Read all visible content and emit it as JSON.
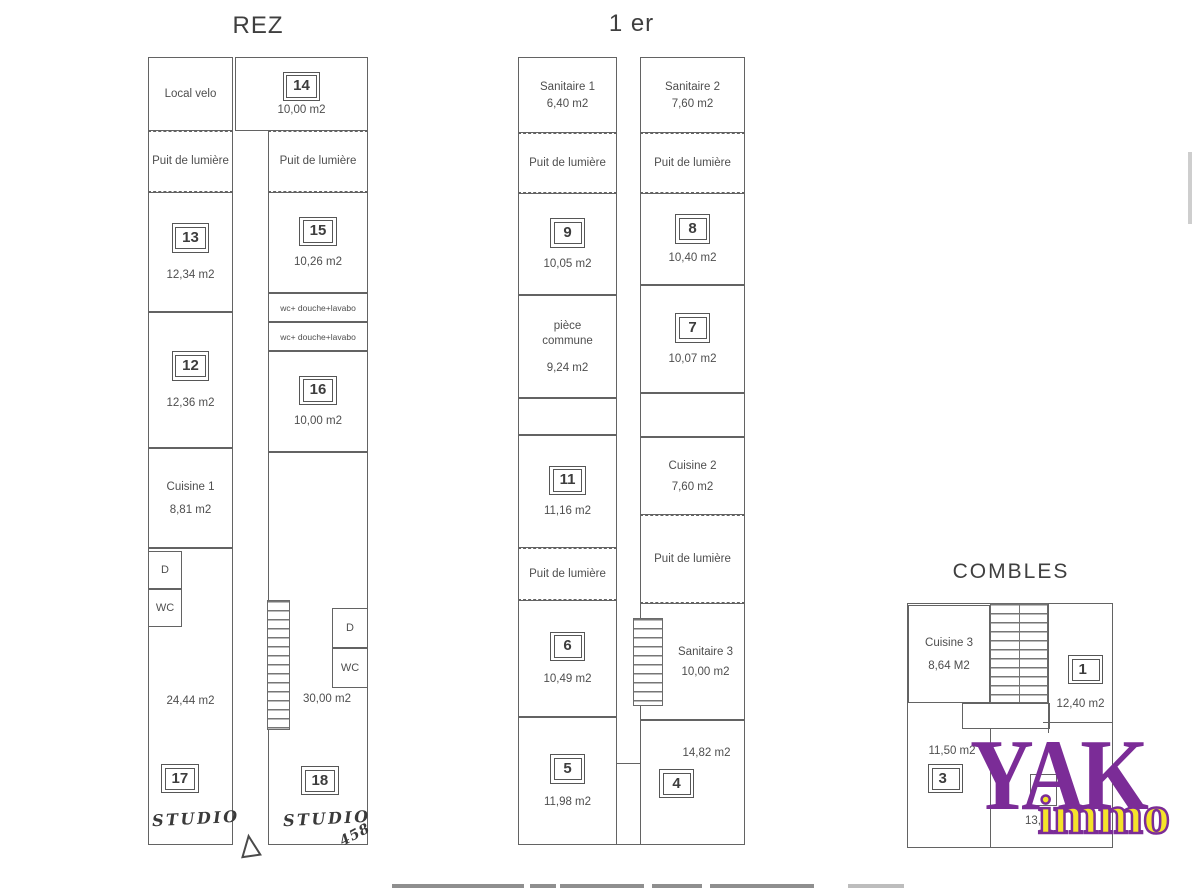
{
  "titles": {
    "rez": "REZ",
    "premier": "1 er",
    "combles": "COMBLES"
  },
  "rez": {
    "local_velo": "Local velo",
    "puit_left": "Puit de lumière",
    "puit_right": "Puit de lumière",
    "r13": {
      "num": "13",
      "area": "12,34 m2"
    },
    "r12": {
      "num": "12",
      "area": "12,36 m2"
    },
    "cuisine": {
      "name": "Cuisine 1",
      "area": "8,81 m2"
    },
    "d_left": "D",
    "wc_left": "WC",
    "r17": {
      "num": "17",
      "area": "24,44 m2",
      "note": "Studio"
    },
    "r14": {
      "num": "14",
      "area": "10,00 m2"
    },
    "r15": {
      "num": "15",
      "area": "10,26 m2"
    },
    "shower1": "wc+ douche+lavabo",
    "shower2": "wc+ douche+lavabo",
    "r16": {
      "num": "16",
      "area": "10,00 m2"
    },
    "d_right": "D",
    "wc_right": "WC",
    "r18": {
      "num": "18",
      "area": "30,00 m2",
      "note": "Studio",
      "scribble": "458"
    }
  },
  "premier": {
    "sanitaire1": {
      "name": "Sanitaire 1",
      "area": "6,40 m2"
    },
    "sanitaire2": {
      "name": "Sanitaire 2",
      "area": "7,60 m2"
    },
    "puit_l1": "Puit de lumière",
    "puit_r1": "Puit de lumière",
    "r9": {
      "num": "9",
      "area": "10,05 m2"
    },
    "r8": {
      "num": "8",
      "area": "10,40 m2"
    },
    "piece": {
      "name": "pièce commune",
      "area": "9,24 m2"
    },
    "r7": {
      "num": "7",
      "area": "10,07 m2"
    },
    "r11": {
      "num": "11",
      "area": "11,16 m2"
    },
    "cuisine2": {
      "name": "Cuisine 2",
      "area": "7,60 m2"
    },
    "puit_l2": "Puit de lumière",
    "puit_r2": "Puit de lumière",
    "r6": {
      "num": "6",
      "area": "10,49 m2"
    },
    "sanitaire3": {
      "name": "Sanitaire 3",
      "area": "10,00 m2"
    },
    "r5": {
      "num": "5",
      "area": "11,98 m2"
    },
    "r4": {
      "num": "4",
      "area": "14,82 m2"
    }
  },
  "combles": {
    "cuisine3": {
      "name": "Cuisine 3",
      "area": "8,64 M2"
    },
    "r1": {
      "num": "1",
      "area": "12,40 m2"
    },
    "r3": {
      "num": "3",
      "area": "11,50 m2"
    },
    "partial": "13,"
  },
  "logo": {
    "word": "YAK",
    "sub": "immo"
  },
  "colors": {
    "logo_purple": "#7b2c97",
    "logo_yellow": "#f5e32a",
    "line": "#636363"
  }
}
